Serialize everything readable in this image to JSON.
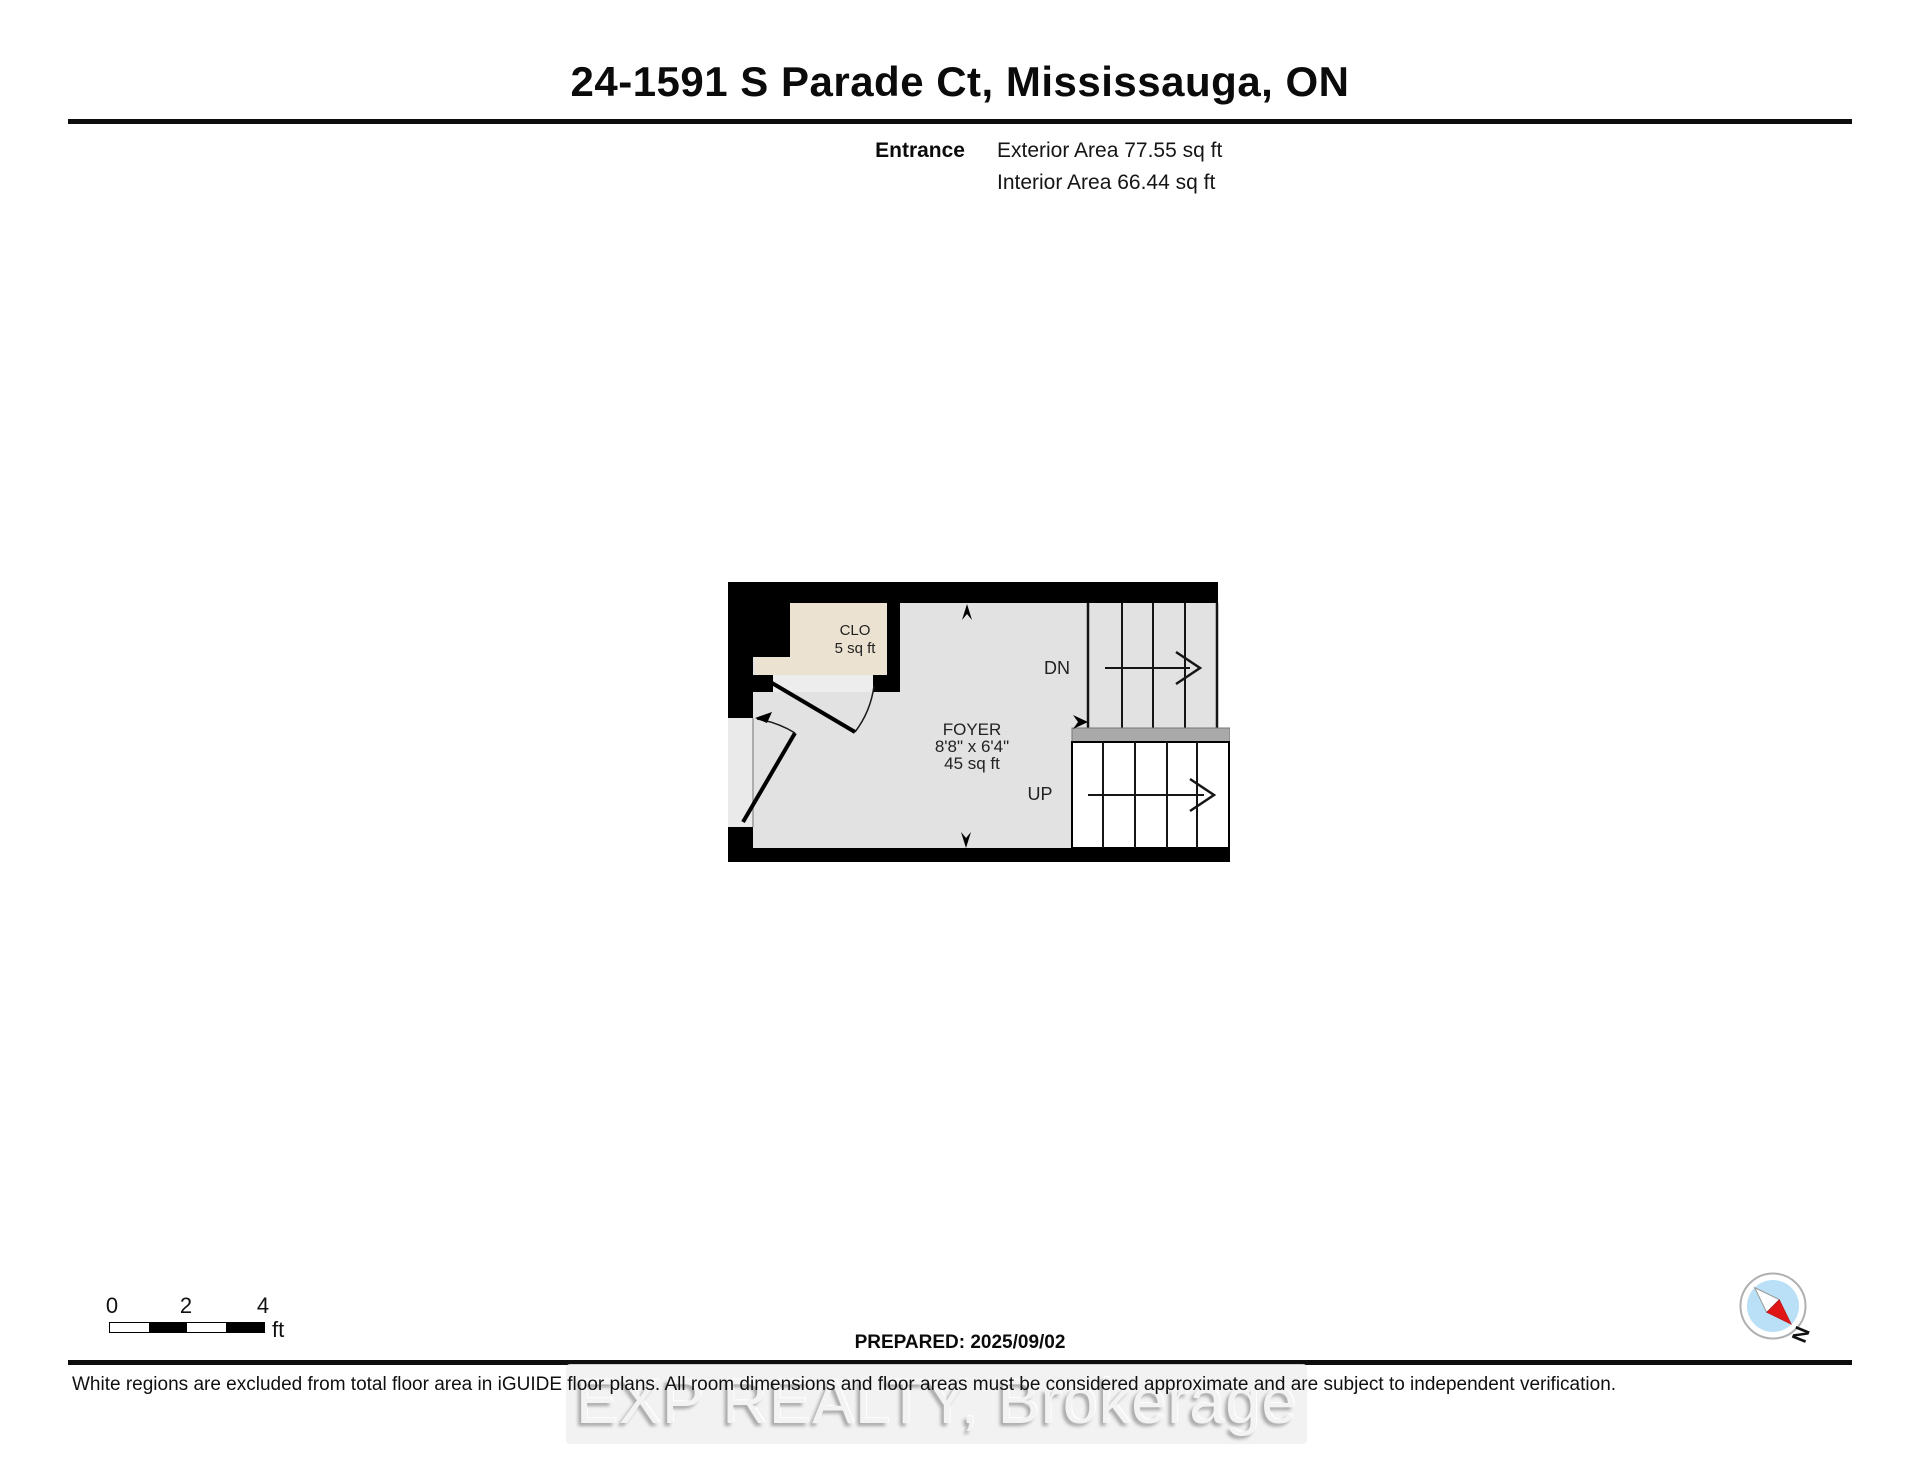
{
  "header": {
    "title": "24-1591 S Parade Ct, Mississauga, ON",
    "floor_label": "Entrance",
    "exterior_area": "Exterior Area 77.55 sq ft",
    "interior_area": "Interior Area 66.44 sq ft"
  },
  "plan": {
    "foyer": {
      "name": "FOYER",
      "dimensions": "8'8\" x 6'4\"",
      "area": "45 sq ft"
    },
    "closet": {
      "name": "CLO",
      "area": "5 sq ft"
    },
    "stairs": {
      "down_label": "DN",
      "up_label": "UP"
    },
    "colors": {
      "wall": "#000000",
      "floor": "#e2e2e2",
      "closet_floor": "#ece2d1",
      "door_opening": "#ededed",
      "entry_recess": "#eaeaea",
      "landing": "#a9a9a9",
      "excluded": "#ffffff"
    }
  },
  "scale_bar": {
    "tick0": "0",
    "tick1": "2",
    "tick2": "4",
    "unit": "ft"
  },
  "footer": {
    "prepared": "PREPARED: 2025/09/02",
    "disclaimer": "White regions are excluded from total floor area in iGUIDE floor plans. All room dimensions and floor areas must be considered approximate and are subject to independent verification.",
    "watermark": "EXP REALTY, Brokerage"
  },
  "compass": {
    "north_label": "N",
    "needle_red": "#e01616",
    "ring_fill": "#b9e0f7"
  }
}
